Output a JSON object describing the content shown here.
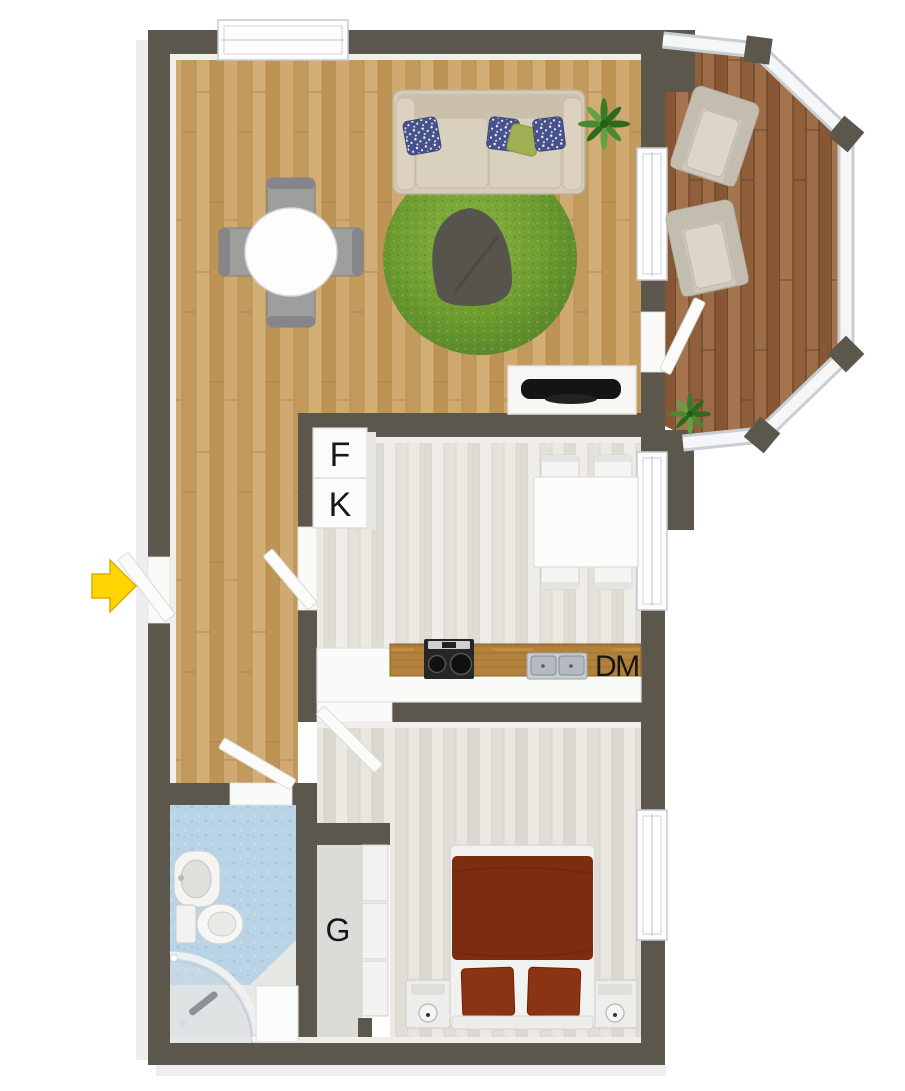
{
  "plan": {
    "type": "apartment-floor-plan-top-view",
    "labels": {
      "freezer": "F",
      "fridge": "K",
      "dishwasher": "DM",
      "wardrobe": "G"
    },
    "colors": {
      "wall": "#5b574d",
      "living_floor_wood": "#c8a268",
      "balcony_deck_wood": "#9a6a45",
      "kitchen_floor": "#eae8e2",
      "bedroom_floor": "#e7e5df",
      "bathroom_floor": "#b9d3e7",
      "rug_green": "#6f9e33",
      "bed_duvet_red": "#7c2d10",
      "sofa_beige": "#d5cbb8",
      "entry_arrow_yellow": "#ffd400",
      "door_white": "#fbfbfa"
    }
  }
}
